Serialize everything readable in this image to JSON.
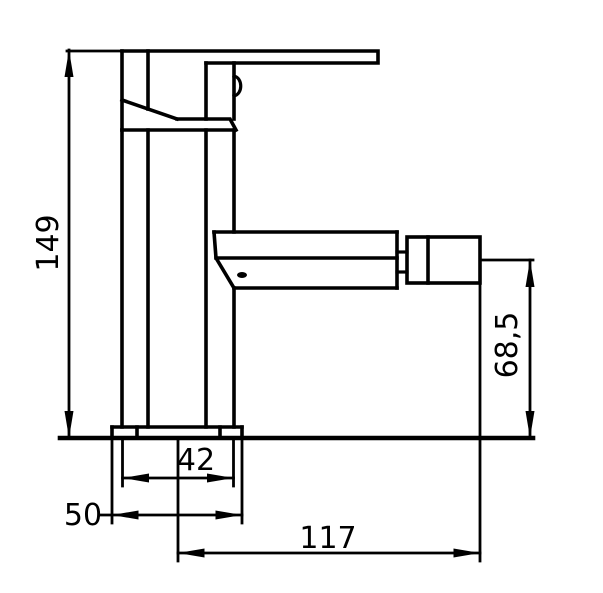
{
  "page": {
    "background_color": "#ffffff",
    "line_color": "#000000"
  },
  "drawing": {
    "labels": {
      "height": "149",
      "body_width": "42",
      "base_width": "50",
      "reach": "117",
      "outlet_height": "68,5"
    }
  }
}
